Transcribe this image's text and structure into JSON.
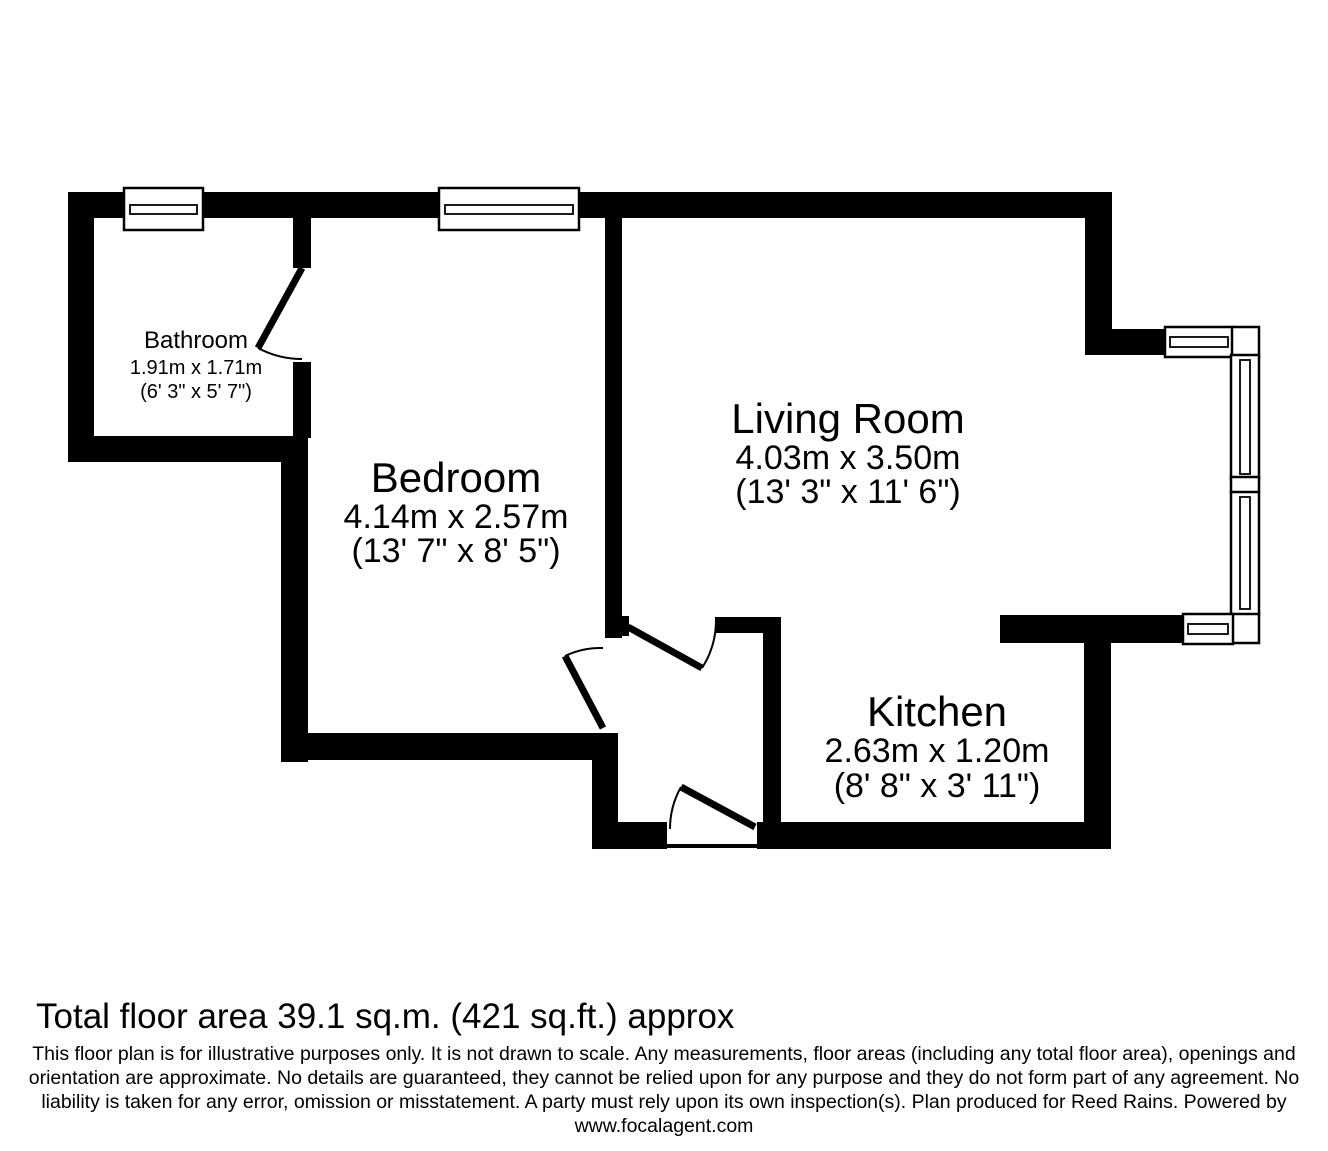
{
  "plan": {
    "rooms": [
      {
        "name": "Bathroom",
        "metric": "1.91m x 1.71m",
        "imperial": "(6' 3\" x 5' 7\")"
      },
      {
        "name": "Bedroom",
        "metric": "4.14m x 2.57m",
        "imperial": "(13' 7\" x 8' 5\")"
      },
      {
        "name": "Living Room",
        "metric": "4.03m x 3.50m",
        "imperial": "(13' 3\" x 11' 6\")"
      },
      {
        "name": "Kitchen",
        "metric": "2.63m x 1.20m",
        "imperial": "(8' 8\" x 3' 11\")"
      }
    ]
  },
  "footer": {
    "total_area": "Total floor area 39.1 sq.m. (421 sq.ft.) approx",
    "disclaimer_lines": [
      "This floor plan is for illustrative purposes only. It is not drawn to scale. Any measurements, floor areas (including any total floor area), openings and",
      "orientation are approximate. No details are guaranteed, they cannot be relied upon for any purpose and they do not form part of any agreement. No",
      "liability is taken for any error, omission or misstatement. A party must rely upon its own inspection(s). Plan produced for Reed Rains. Powered by",
      "www.focalagent.com"
    ]
  },
  "colors": {
    "wall": "#000000",
    "background": "#ffffff",
    "text": "#000000"
  }
}
